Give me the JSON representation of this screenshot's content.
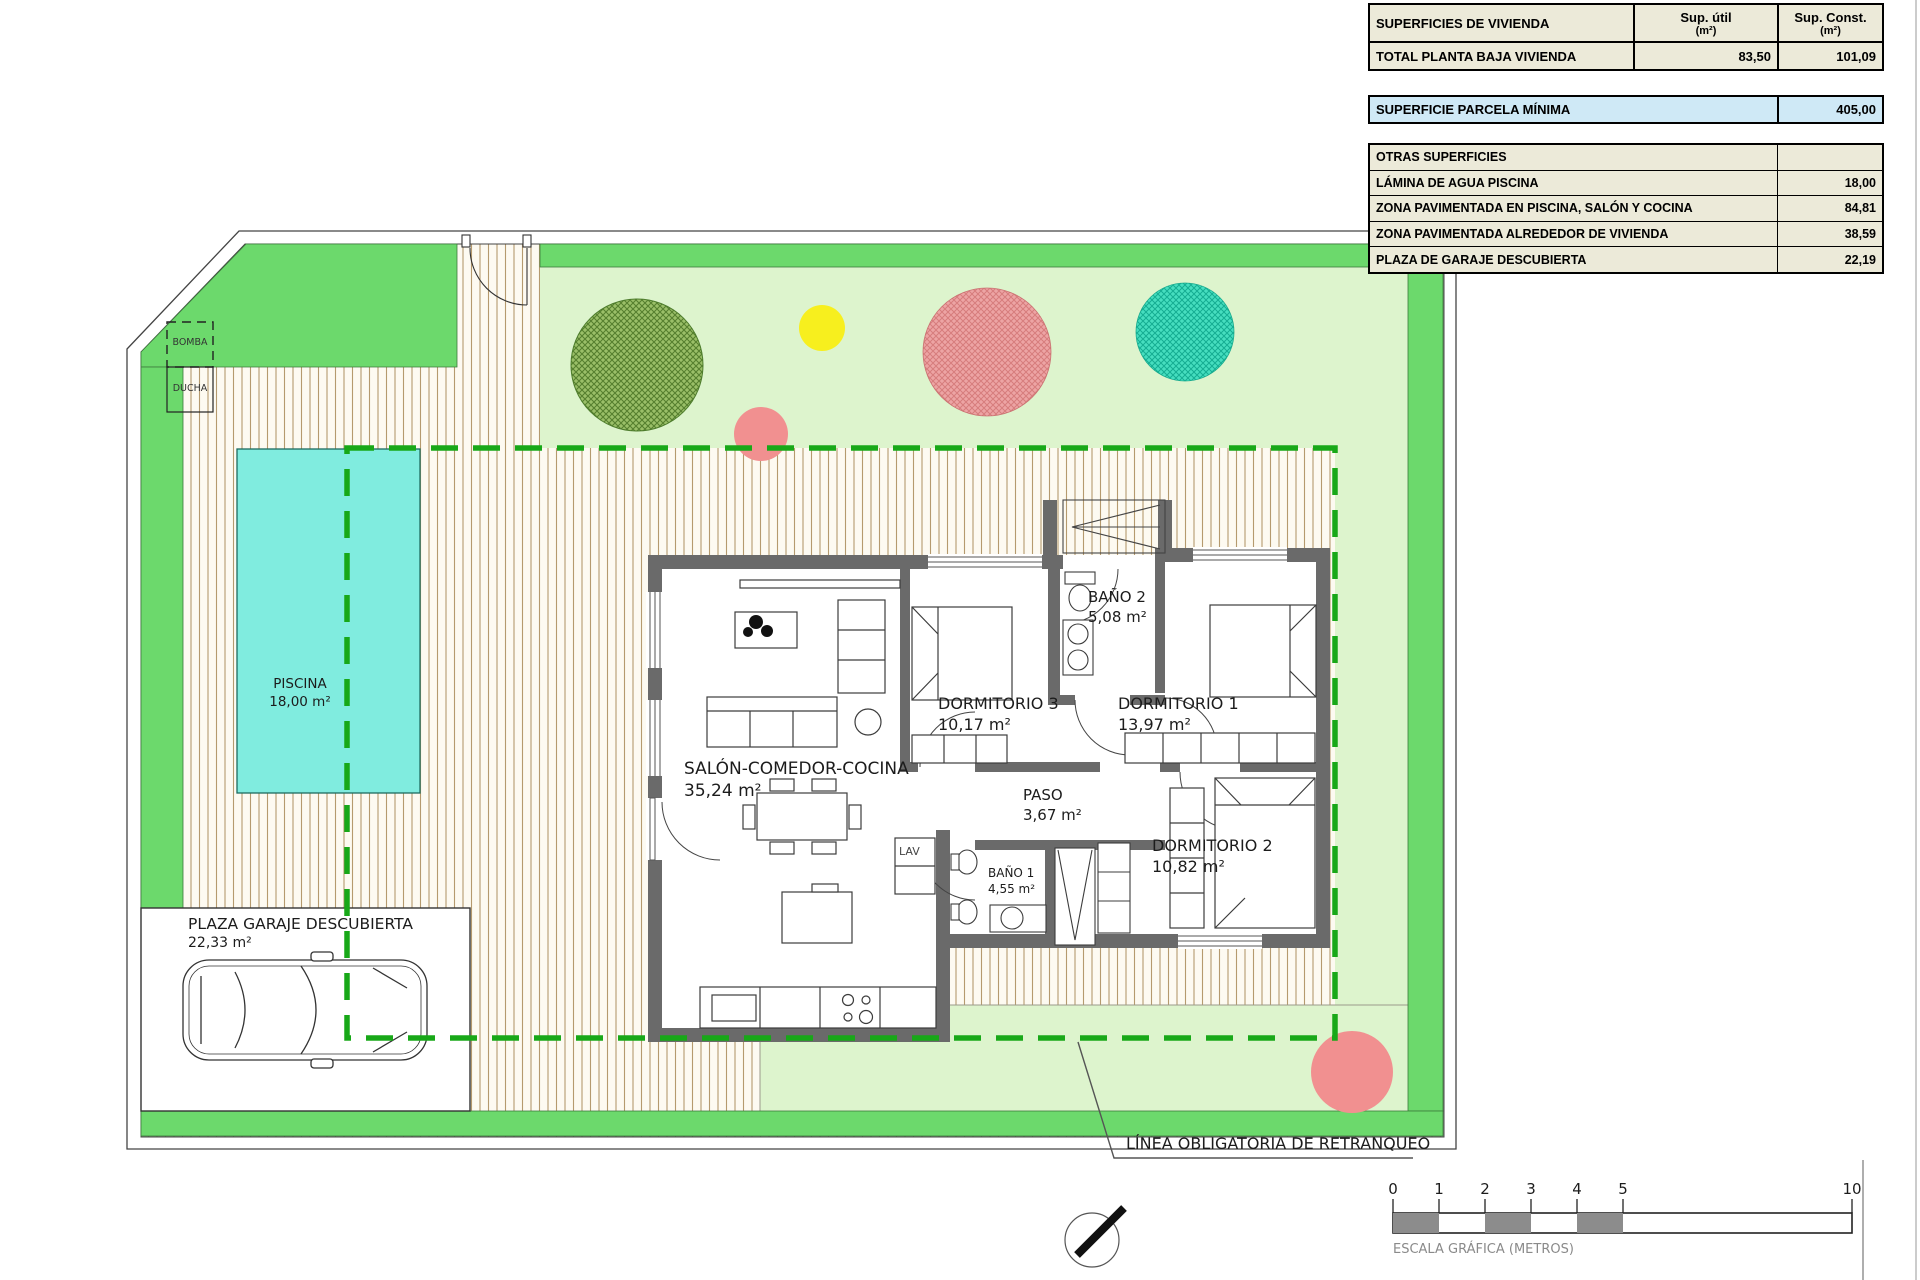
{
  "table_vivienda": {
    "title": "SUPERFICIES DE VIVIENDA",
    "col_util": "Sup. útil",
    "col_const": "Sup. Const.",
    "col_unit": "(m²)",
    "total": {
      "label": "TOTAL PLANTA BAJA VIVIENDA",
      "util": "83,50",
      "const": "101,09"
    }
  },
  "table_parcela": {
    "label": "SUPERFICIE PARCELA MÍNIMA",
    "value": "405,00"
  },
  "table_otras": {
    "header": "OTRAS SUPERFICIES",
    "rows": [
      {
        "label": "LÁMINA DE AGUA PISCINA",
        "value": "18,00"
      },
      {
        "label": "ZONA PAVIMENTADA EN PISCINA, SALÓN Y COCINA",
        "value": "84,81"
      },
      {
        "label": "ZONA PAVIMENTADA ALREDEDOR DE VIVIENDA",
        "value": "38,59"
      },
      {
        "label": "PLAZA DE GARAJE DESCUBIERTA",
        "value": "22,19"
      }
    ]
  },
  "plan": {
    "rooms": [
      {
        "name": "SALÓN-COMEDOR-COCINA",
        "area": "35,24 m²"
      },
      {
        "name": "DORMITORIO 3",
        "area": "10,17 m²"
      },
      {
        "name": "BAÑO 2",
        "area": "5,08 m²"
      },
      {
        "name": "DORMITORIO 1",
        "area": "13,97 m²"
      },
      {
        "name": "PASO",
        "area": "3,67 m²"
      },
      {
        "name": "BAÑO 1",
        "area": "4,55 m²"
      },
      {
        "name": "DORMITORIO 2",
        "area": "10,82 m²"
      }
    ],
    "piscina": {
      "name": "PISCINA",
      "area": "18,00 m²"
    },
    "garaje": {
      "name": "PLAZA GARAJE DESCUBIERTA",
      "area": "22,33 m²"
    },
    "bomba": "BOMBA",
    "ducha": "DUCHA",
    "lav": "LAV",
    "setback_label": "LÍNEA OBLIGATORIA DE RETRANQUEO"
  },
  "scale_bar": {
    "ticks": [
      "0",
      "1",
      "2",
      "3",
      "4",
      "5",
      "10"
    ],
    "caption": "ESCALA GRÁFICA (METROS)"
  },
  "colors": {
    "lawn_green": "#6cd96c",
    "garden_pale_green": "#ddf4cd",
    "pool_cyan": "#80ecdf",
    "setback_dash_green": "#18a818",
    "wall_gray": "#6a6a6a",
    "table_beige": "#ecead9",
    "table_blue": "#cfe9f6",
    "tree_dark_green": "#9abf68",
    "tree_pink": "#eda4a4",
    "tree_teal": "#46debf",
    "tree_yellow": "#f7ef1e"
  }
}
